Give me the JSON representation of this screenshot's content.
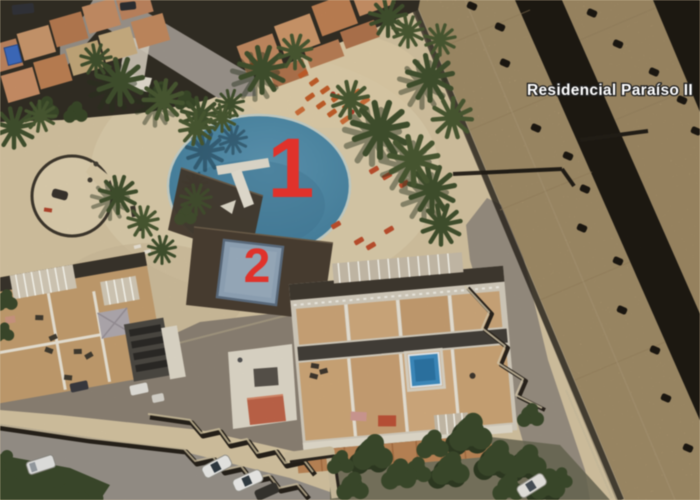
{
  "map": {
    "description": "Aerial satellite view of a holiday residential complex with two numbered swimming pools",
    "place_label": "Residencial Paraíso II",
    "markers": [
      {
        "label": "1",
        "feature": "large-round-pool"
      },
      {
        "label": "2",
        "feature": "small-square-pool"
      }
    ]
  },
  "colors": {
    "marker_red": "#e0322b",
    "place_label_fill": "#ffffff",
    "place_label_outline": "#1f1f1f",
    "pool_water": "#4b87a5",
    "small_pool_water": "#94a8bb",
    "pool_deck_brown": "#4a3e33",
    "sand_paving": "#d8c7a4",
    "terracotta_roof": "#c28760",
    "large_roof_tan": "#cbb183",
    "roof_gap_dark": "#28231c",
    "road_gray": "#9b958c",
    "plaza_gray": "#8e8476",
    "vegetation_green": "#42522e",
    "sun_lounger_orange": "#c65f2a"
  }
}
